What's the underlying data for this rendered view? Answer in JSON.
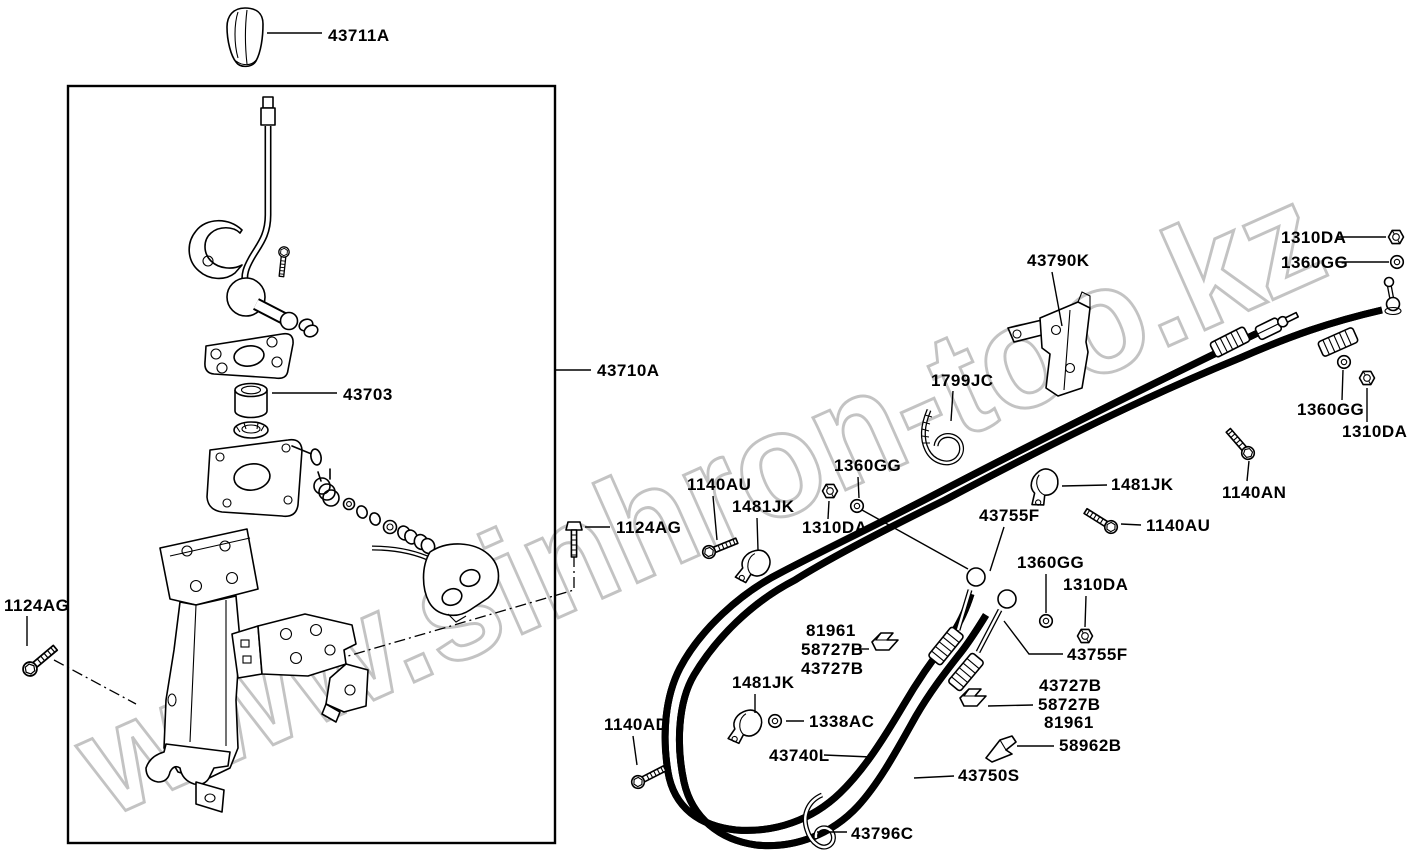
{
  "watermark": {
    "text": "www.sinhron-too.kz"
  },
  "colors": {
    "background": "#ffffff",
    "line": "#000000",
    "label_text": "#000000",
    "watermark_outline": "#c3c3c3"
  },
  "parts_diagram": {
    "labels": [
      {
        "id": "43711A",
        "text": "43711A",
        "x": 328,
        "y": 41
      },
      {
        "id": "43710A",
        "text": "43710A",
        "x": 597,
        "y": 376
      },
      {
        "id": "43703",
        "text": "43703",
        "x": 343,
        "y": 400
      },
      {
        "id": "1124AG-left",
        "text": "1124AG",
        "x": 4,
        "y": 611
      },
      {
        "id": "1124AG-mid",
        "text": "1124AG",
        "x": 616,
        "y": 533
      },
      {
        "id": "1140AU-top",
        "text": "1140AU",
        "x": 687,
        "y": 490
      },
      {
        "id": "1481JK-top",
        "text": "1481JK",
        "x": 732,
        "y": 512
      },
      {
        "id": "1310DA-mid",
        "text": "1310DA",
        "x": 802,
        "y": 533
      },
      {
        "id": "1360GG-mid",
        "text": "1360GG",
        "x": 834,
        "y": 471
      },
      {
        "id": "1799JC",
        "text": "1799JC",
        "x": 931,
        "y": 386
      },
      {
        "id": "43790K",
        "text": "43790K",
        "x": 1027,
        "y": 266
      },
      {
        "id": "1310DA-topright",
        "text": "1310DA",
        "x": 1281,
        "y": 243
      },
      {
        "id": "1360GG-topright",
        "text": "1360GG",
        "x": 1281,
        "y": 268
      },
      {
        "id": "1360GG-right",
        "text": "1360GG",
        "x": 1297,
        "y": 415
      },
      {
        "id": "1310DA-right",
        "text": "1310DA",
        "x": 1342,
        "y": 437
      },
      {
        "id": "1481JK-cable",
        "text": "1481JK",
        "x": 1111,
        "y": 490
      },
      {
        "id": "1140AN",
        "text": "1140AN",
        "x": 1222,
        "y": 498
      },
      {
        "id": "1140AU-right",
        "text": "1140AU",
        "x": 1146,
        "y": 531
      },
      {
        "id": "43755F-upper",
        "text": "43755F",
        "x": 979,
        "y": 521
      },
      {
        "id": "1360GG-lower",
        "text": "1360GG",
        "x": 1017,
        "y": 568
      },
      {
        "id": "1310DA-lower",
        "text": "1310DA",
        "x": 1063,
        "y": 590
      },
      {
        "id": "43755F-lower",
        "text": "43755F",
        "x": 1067,
        "y": 660
      },
      {
        "id": "81961-left",
        "text": "81961",
        "x": 806,
        "y": 636
      },
      {
        "id": "58727B-left",
        "text": "58727B",
        "x": 801,
        "y": 655
      },
      {
        "id": "43727B-left",
        "text": "43727B",
        "x": 801,
        "y": 674
      },
      {
        "id": "1481JK-loop",
        "text": "1481JK",
        "x": 732,
        "y": 688
      },
      {
        "id": "1338AC",
        "text": "1338AC",
        "x": 809,
        "y": 727
      },
      {
        "id": "1140AD",
        "text": "1140AD",
        "x": 604,
        "y": 730
      },
      {
        "id": "43740L",
        "text": "43740L",
        "x": 769,
        "y": 761
      },
      {
        "id": "43750S",
        "text": "43750S",
        "x": 958,
        "y": 781
      },
      {
        "id": "43796C",
        "text": "43796C",
        "x": 851,
        "y": 839
      },
      {
        "id": "43727B-right",
        "text": "43727B",
        "x": 1039,
        "y": 691
      },
      {
        "id": "58727B-right",
        "text": "58727B",
        "x": 1038,
        "y": 710
      },
      {
        "id": "81961-right",
        "text": "81961",
        "x": 1044,
        "y": 728
      },
      {
        "id": "58962B",
        "text": "58962B",
        "x": 1059,
        "y": 751
      }
    ]
  }
}
